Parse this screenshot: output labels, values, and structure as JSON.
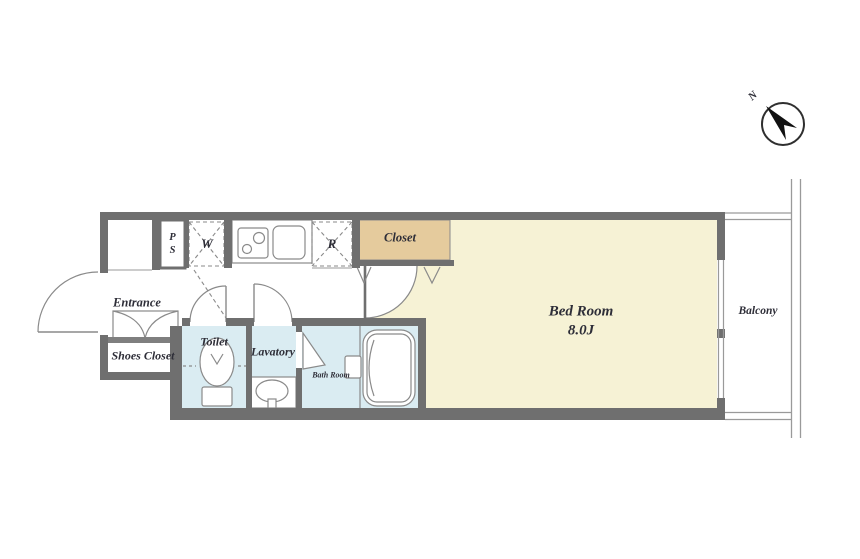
{
  "floor_plan": {
    "compass": {
      "north_label": "N"
    },
    "labels": {
      "entrance": "Entrance",
      "shoes_closet": "Shoes Closet",
      "toilet": "Toilet",
      "lavatory": "Lavatory",
      "bath_room": "Bath Room",
      "closet": "Closet",
      "bed_room": "Bed Room",
      "bed_room_size": "8.0J",
      "balcony": "Balcony",
      "pipe_shaft_line1": "P",
      "pipe_shaft_line2": "S",
      "washing_machine": "W",
      "refrigerator": "R"
    },
    "colors": {
      "wall": "#6f6f6f",
      "bedroom_floor": "#f6f2d5",
      "closet_floor": "#e5cb9d",
      "wet_area_floor": "#daecf2",
      "outline": "#8a8a8a",
      "text": "#2e2e38",
      "background": "#ffffff"
    }
  }
}
